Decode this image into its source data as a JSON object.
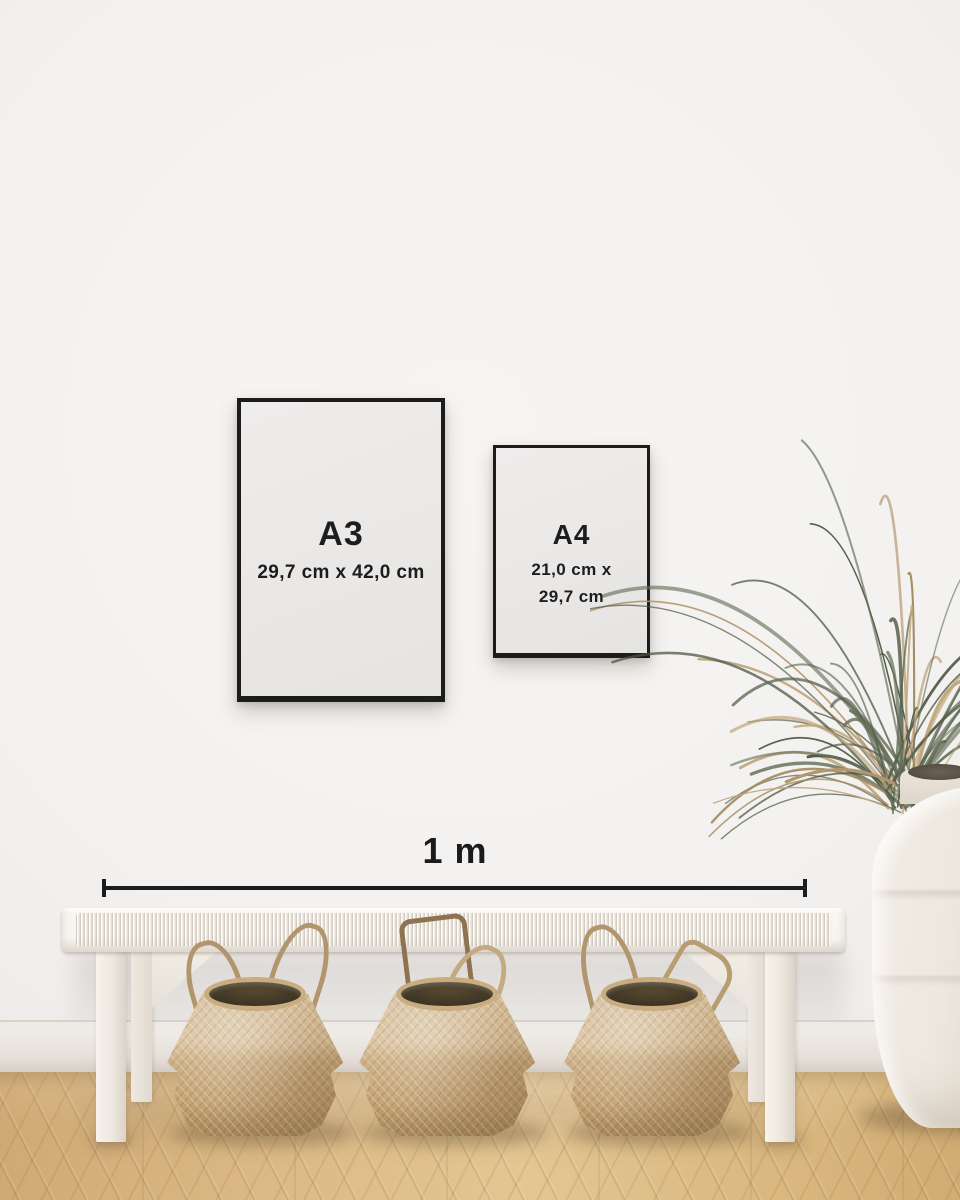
{
  "frames": [
    {
      "label": "A3",
      "dimensions": "29,7 cm x 42,0 cm"
    },
    {
      "label": "A4",
      "dimensions_line1": "21,0 cm x",
      "dimensions_line2": "29,7 cm"
    }
  ],
  "scale_bar": {
    "label": "1 m"
  },
  "colors": {
    "frame_border": "#1c1c1c",
    "label_text": "#1d1d1d",
    "scale_line": "#1d1d1d",
    "wall": "#f4f2f0",
    "baseboard": "#eae5e0",
    "floor_wood": "#dcba85",
    "bench_white": "#f8f5f1",
    "basket_weave": "#c8ab80",
    "vase_ceramic": "#ece6dd",
    "plant_green": "#5d674f",
    "plant_dry": "#b3966c"
  }
}
